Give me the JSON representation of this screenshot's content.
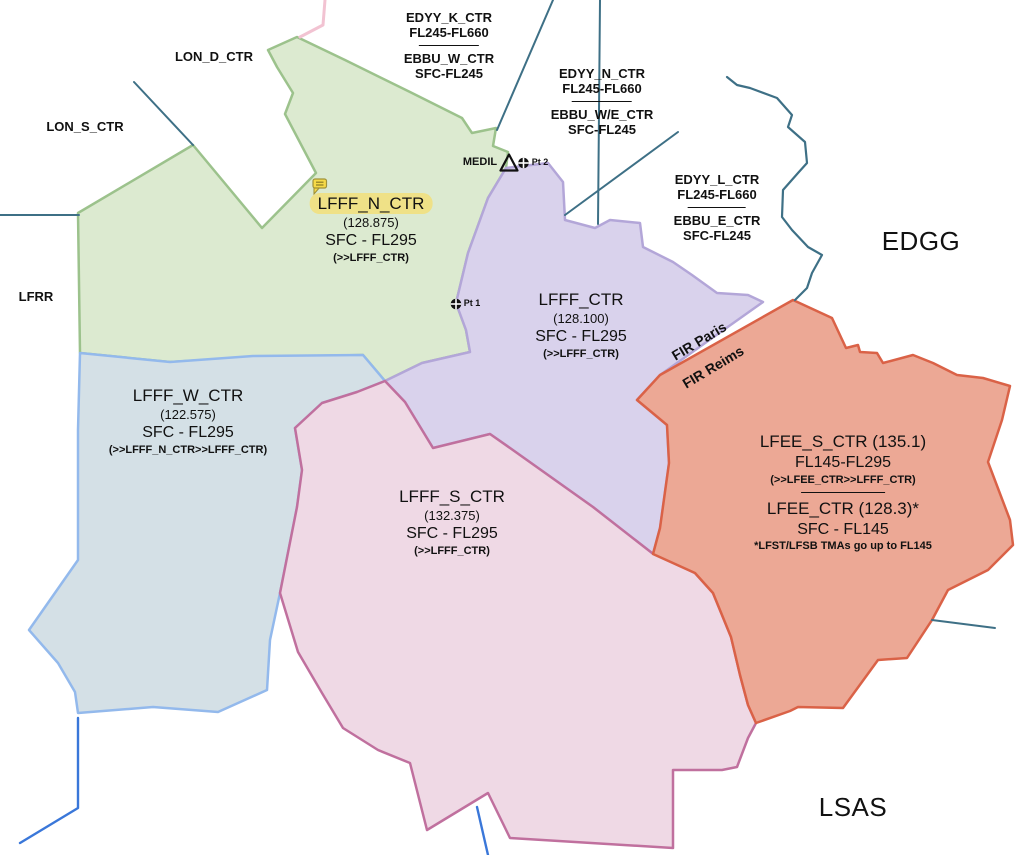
{
  "map": {
    "background": "#ffffff",
    "regions": [
      {
        "id": "lfff-n-ctr-region",
        "sector": "LFFF_N_CTR",
        "fill": "#dcead0",
        "stroke": "#9cc28c",
        "points": "297,37 345,60 410,92 462,118 472,133 496,128 493,146 508,152 506,168 488,198 468,253 456,303 466,330 470,352 422,363 385,381 363,355 253,357 170,362 80,353 78,213 193,145 262,228 316,173 285,114 293,93 277,67 268,50"
      },
      {
        "id": "lfff-w-ctr-region",
        "sector": "LFFF_W_CTR",
        "fill": "#d4e0e6",
        "stroke": "#93b9ec",
        "points": "80,353 170,362 253,356 363,355 385,381 357,392 322,403 295,428 302,470 297,507 280,593 270,640 267,690 218,712 153,707 78,713 75,692 58,663 29,630 78,560 78,430"
      },
      {
        "id": "lfff-ctr-region",
        "sector": "LFFF_CTR",
        "fill": "#d9d2ec",
        "stroke": "#b3a6d8",
        "points": "506,168 548,163 563,182 565,220 595,228 610,220 640,223 643,247 653,252 673,262 692,275 717,293 748,295 763,302 660,375 637,400 667,425 669,463 660,528 653,554 593,507 510,448 490,434 433,448 405,402 385,381 422,363 470,352 466,330 456,303 468,253 488,198"
      },
      {
        "id": "lfff-s-ctr-region",
        "sector": "LFFF_S_CTR",
        "fill": "#efd9e5",
        "stroke": "#c0709e",
        "points": "295,428 322,403 357,392 385,381 405,402 433,448 490,434 510,448 593,507 652,553 695,573 713,593 731,637 740,675 748,705 756,723 748,738 737,767 722,770 673,770 673,848 510,838 488,793 427,830 410,763 378,750 343,728 322,693 298,652 280,593 297,507 302,470"
      },
      {
        "id": "lfee-region",
        "sector": "LFEE_S_CTR / LFEE_CTR",
        "fill": "#eca895",
        "stroke": "#da6247",
        "points": "793,300 832,318 846,348 858,345 860,352 877,353 883,363 913,355 933,363 957,375 983,378 1010,386 1002,420 988,462 1010,520 1013,545 988,570 948,590 932,620 907,658 878,660 843,708 798,707 790,711 756,723 748,705 740,675 731,637 713,593 695,573 653,554 660,528 669,463 667,425 637,400 660,375"
      }
    ],
    "lines": [
      {
        "id": "boundary-left-horizontal",
        "color": "#3e7086",
        "width": 2,
        "points": "0,215 79,215"
      },
      {
        "id": "boundary-lon-diagonal",
        "color": "#3e7086",
        "width": 2,
        "points": "134,82 193,145"
      },
      {
        "id": "boundary-top-diagonal",
        "color": "#3e7086",
        "width": 2,
        "points": "553,0 497,130"
      },
      {
        "id": "boundary-top-vertical",
        "color": "#3e7086",
        "width": 2,
        "points": "600,0 598,224"
      },
      {
        "id": "boundary-center-diagonal",
        "color": "#3e7086",
        "width": 2,
        "points": "678,132 565,215"
      },
      {
        "id": "boundary-edgg-border",
        "color": "#3e7086",
        "width": 2.2,
        "points": "727,77 737,85 750,88 777,98 792,115 788,127 805,142 807,163 798,173 783,190 782,217 792,230 808,247 822,255 812,273 807,288 795,300"
      },
      {
        "id": "boundary-east",
        "color": "#3e7086",
        "width": 2,
        "points": "932,620 995,628"
      },
      {
        "id": "river-southwest",
        "color": "#3a77d9",
        "width": 2.4,
        "points": "78,718 78,808 20,843"
      },
      {
        "id": "river-south",
        "color": "#3a77d9",
        "width": 2.4,
        "points": "477,807 488,855"
      },
      {
        "id": "boundary-pink-top",
        "color": "#f2c3d2",
        "width": 3,
        "points": "325,0 323,25 300,37"
      }
    ],
    "markers": {
      "waypoint_triangle": {
        "name": "MEDIL",
        "points": "509,154.5 500.5,170.5 517.5,170.5",
        "stroke": "#111111"
      },
      "position_points": [
        {
          "name": "Pt 2",
          "x": 523.5,
          "y": 163
        },
        {
          "name": "Pt 1",
          "x": 456,
          "y": 304
        }
      ],
      "flag": {
        "x": 313,
        "y": 179,
        "fill": "#f6da47",
        "stroke": "#a0923a",
        "lines": "#8a7c25"
      }
    },
    "highlight_color": "#efe187"
  },
  "labels": {
    "blocks": [
      {
        "id": "edyy-k-label",
        "x": 449,
        "y": 10,
        "lines": [
          {
            "s": "ext",
            "t": "EDYY_K_CTR"
          },
          {
            "s": "ext",
            "t": "FL245-FL660"
          },
          {
            "s": "divider",
            "w": 60
          },
          {
            "s": "ext",
            "t": "EBBU_W_CTR"
          },
          {
            "s": "ext",
            "t": "SFC-FL245"
          }
        ]
      },
      {
        "id": "edyy-n-label",
        "x": 602,
        "y": 66,
        "lines": [
          {
            "s": "ext",
            "t": "EDYY_N_CTR"
          },
          {
            "s": "ext",
            "t": "FL245-FL660"
          },
          {
            "s": "divider",
            "w": 60
          },
          {
            "s": "ext",
            "t": "EBBU_W/E_CTR"
          },
          {
            "s": "ext",
            "t": "SFC-FL245"
          }
        ]
      },
      {
        "id": "edyy-l-label",
        "x": 717,
        "y": 172,
        "lines": [
          {
            "s": "ext",
            "t": "EDYY_L_CTR"
          },
          {
            "s": "ext",
            "t": "FL245-FL660"
          },
          {
            "s": "divider",
            "w": 58
          },
          {
            "s": "ext",
            "t": "EBBU_E_CTR"
          },
          {
            "s": "ext",
            "t": "SFC-FL245"
          }
        ]
      },
      {
        "id": "lon-d-label",
        "x": 214,
        "y": 49,
        "lines": [
          {
            "s": "ext",
            "t": "LON_D_CTR"
          }
        ]
      },
      {
        "id": "lon-s-label",
        "x": 85,
        "y": 119,
        "lines": [
          {
            "s": "ext",
            "t": "LON_S_CTR"
          }
        ]
      },
      {
        "id": "lfrr-label",
        "x": 36,
        "y": 289,
        "lines": [
          {
            "s": "ext",
            "t": "LFRR"
          }
        ]
      },
      {
        "id": "edgg-label",
        "x": 921,
        "y": 226,
        "lines": [
          {
            "s": "area",
            "t": "EDGG"
          }
        ]
      },
      {
        "id": "lsas-label",
        "x": 853,
        "y": 792,
        "lines": [
          {
            "s": "area",
            "t": "LSAS"
          }
        ]
      },
      {
        "id": "lfff-n-label",
        "x": 371,
        "y": 193,
        "lines": [
          {
            "s": "title",
            "t": "LFFF_N_CTR",
            "hl": true,
            "sector": true
          },
          {
            "s": "freq",
            "t": "(128.875)"
          },
          {
            "s": "alt",
            "t": "SFC - FL295"
          },
          {
            "s": "hand",
            "t": "(>>LFFF_CTR)"
          }
        ]
      },
      {
        "id": "lfff-label",
        "x": 581,
        "y": 289,
        "lines": [
          {
            "s": "title",
            "t": "LFFF_CTR",
            "sector": true
          },
          {
            "s": "freq",
            "t": "(128.100)"
          },
          {
            "s": "alt",
            "t": "SFC - FL295"
          },
          {
            "s": "hand",
            "t": "(>>LFFF_CTR)"
          }
        ]
      },
      {
        "id": "lfff-w-label",
        "x": 188,
        "y": 385,
        "lines": [
          {
            "s": "title",
            "t": "LFFF_W_CTR",
            "sector": true
          },
          {
            "s": "freq",
            "t": "(122.575)"
          },
          {
            "s": "alt",
            "t": "SFC - FL295"
          },
          {
            "s": "hand",
            "t": "(>>LFFF_N_CTR>>LFFF_CTR)"
          }
        ]
      },
      {
        "id": "lfff-s-label",
        "x": 452,
        "y": 486,
        "lines": [
          {
            "s": "title",
            "t": "LFFF_S_CTR",
            "sector": true
          },
          {
            "s": "freq",
            "t": "(132.375)"
          },
          {
            "s": "alt",
            "t": "SFC - FL295"
          },
          {
            "s": "hand",
            "t": "(>>LFFF_CTR)"
          }
        ]
      },
      {
        "id": "lfee-label",
        "x": 843,
        "y": 431,
        "lines": [
          {
            "s": "title",
            "t": "LFEE_S_CTR (135.1)",
            "sector": true
          },
          {
            "s": "alt",
            "t": "FL145-FL295"
          },
          {
            "s": "hand",
            "t": "(>>LFEE_CTR>>LFFF_CTR)"
          },
          {
            "s": "divider",
            "w": 84
          },
          {
            "s": "title",
            "t": "LFEE_CTR (128.3)*",
            "sector": true
          },
          {
            "s": "alt",
            "t": "SFC - FL145"
          },
          {
            "s": "note",
            "t": "*LFST/LFSB TMAs go up to FL145"
          }
        ]
      },
      {
        "id": "medil-label",
        "x": 480,
        "y": 156,
        "lines": [
          {
            "s": "wpt",
            "t": "MEDIL"
          }
        ]
      },
      {
        "id": "pt2-label",
        "x": 540,
        "y": 157,
        "lines": [
          {
            "s": "pt",
            "t": "Pt 2"
          }
        ]
      },
      {
        "id": "pt1-label",
        "x": 472,
        "y": 298,
        "lines": [
          {
            "s": "pt",
            "t": "Pt 1"
          }
        ]
      }
    ],
    "rotated": [
      {
        "id": "fir-paris-label",
        "x": 699,
        "y": 341,
        "rot": -31,
        "t": "FIR Paris"
      },
      {
        "id": "fir-reims-label",
        "x": 713,
        "y": 367,
        "rot": -31,
        "t": "FIR Reims"
      }
    ]
  }
}
